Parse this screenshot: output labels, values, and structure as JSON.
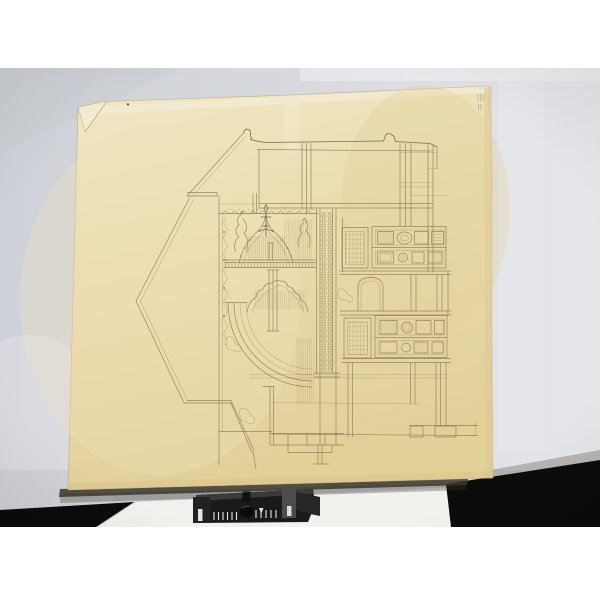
{
  "scene": {
    "type": "photograph",
    "subject": "antique architectural elevation drawing in fine sepia line on a large aged cream sheet",
    "paper": {
      "corner_fold": "top-left corner dog-eared",
      "inventory_mark": "faint illegible handwritten mark near top-right corner"
    },
    "drawing": {
      "subject": "half section / elevation of an ornamented bay with gothic canopy, fan arcs, carved pier and panelled wall",
      "legible_text": ""
    },
    "foreground_object": "black sliding rail device with knob and white scale tick marks at bottom edge",
    "device_scale": {
      "left_tick_count": 6,
      "right_tick_count": 5
    }
  },
  "colors": {
    "page_bg": "#ffffff",
    "backdrop": "#d4d7dc",
    "backdrop_dark": "#c7cad1",
    "backdrop_light": "#e7e8eb",
    "seam": "#f2f3f5",
    "paper": "#e9dcae",
    "paper_light": "#f3ecd4",
    "paper_dark": "#dcc992",
    "paper_edge": "#bfae7f",
    "ink": "#8b7a57",
    "ink_dark": "#6e5f44",
    "shadow": "#3c372c",
    "black": "#0b0b0b",
    "table": "#f1f1ee",
    "device": "#1a1a1a",
    "device_top": "#3a3a3a",
    "device_cap": "#4c4c48",
    "marking": "#e6e6e1",
    "mark_ink": "#8d938e"
  }
}
